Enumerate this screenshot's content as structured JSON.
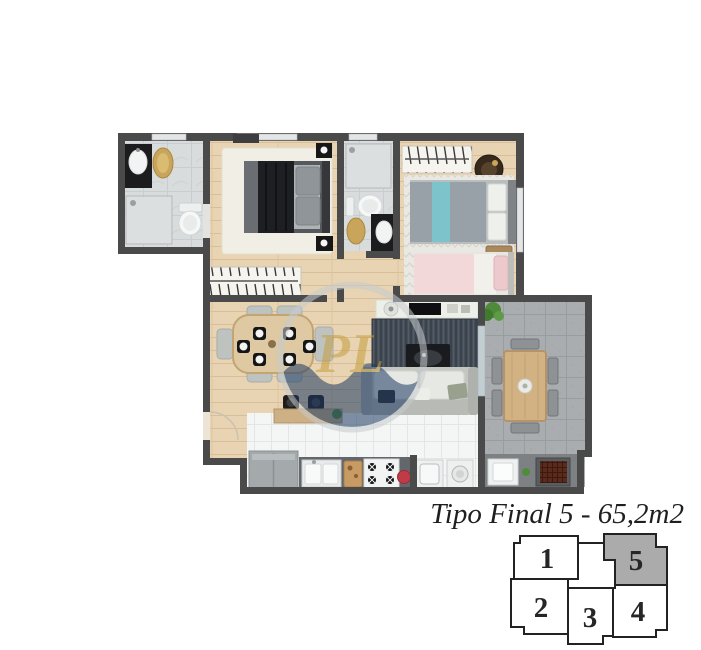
{
  "title": "Tipo Final 5 - 65,2m2",
  "watermark": {
    "letters": "PL"
  },
  "keyplan": {
    "highlighted_unit": "5",
    "highlight_color": "#ababab",
    "units": [
      {
        "label": "1",
        "highlighted": false
      },
      {
        "label": "2",
        "highlighted": false
      },
      {
        "label": "3",
        "highlighted": false
      },
      {
        "label": "4",
        "highlighted": false
      },
      {
        "label": "5",
        "highlighted": true
      }
    ]
  },
  "colors": {
    "wall": "#4a4a4b",
    "wood_floor": "#e8d4b2",
    "bath_tile": "#d9dcdd",
    "kitchen_tile": "#f4f6f5",
    "balcony_tile": "#a9adb0",
    "living_rug": "#47505a",
    "bed_dark": "#1e1f23",
    "bed_blue": "#7cc3cb",
    "bed_pink": "#f3d8da",
    "kettle_red": "#c13b47",
    "plant_green": "#4f8c3c",
    "accent_gold": "#c8a55b",
    "watermark_gold": "#c59d3e",
    "watermark_navy": "#1d3a63"
  }
}
